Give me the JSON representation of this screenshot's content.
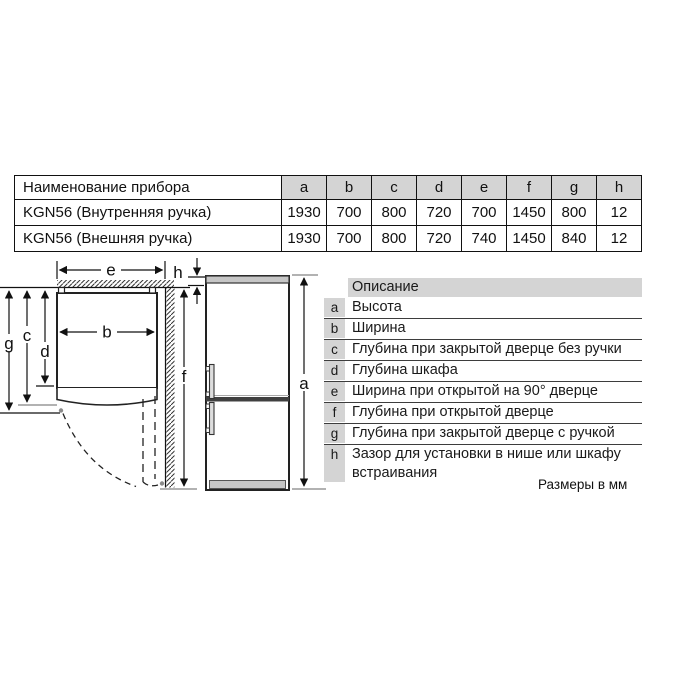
{
  "spec_table": {
    "name_header": "Наименование прибора",
    "dim_headers": [
      "a",
      "b",
      "c",
      "d",
      "e",
      "f",
      "g",
      "h"
    ],
    "rows": [
      {
        "name": "KGN56 (Внутренняя ручка)",
        "values": [
          "1930",
          "700",
          "800",
          "720",
          "700",
          "1450",
          "800",
          "12"
        ]
      },
      {
        "name": "KGN56 (Внешняя ручка)",
        "values": [
          "1930",
          "700",
          "800",
          "720",
          "740",
          "1450",
          "840",
          "12"
        ]
      }
    ]
  },
  "diagram": {
    "labels": {
      "a": "a",
      "b": "b",
      "c": "c",
      "d": "d",
      "e": "e",
      "f": "f",
      "g": "g",
      "h": "h"
    }
  },
  "legend": {
    "header": "Описание",
    "items": [
      {
        "key": "a",
        "text": "Высота"
      },
      {
        "key": "b",
        "text": "Ширина"
      },
      {
        "key": "c",
        "text": "Глубина при закрытой дверце без ручки"
      },
      {
        "key": "d",
        "text": "Глубина шкафа"
      },
      {
        "key": "e",
        "text": "Ширина при открытой на 90° дверце"
      },
      {
        "key": "f",
        "text": "Глубина при открытой дверце"
      },
      {
        "key": "g",
        "text": "Глубина при закрытой дверце с ручкой"
      },
      {
        "key": "h",
        "text": "Зазор для установки в нише или шкафу встраивания"
      }
    ]
  },
  "footnote": "Размеры в мм",
  "colors": {
    "table_header_bg": "#d4d4d4",
    "line": "#111111",
    "gray_accent": "#999999",
    "fridge_band": "#c6c6c6"
  }
}
